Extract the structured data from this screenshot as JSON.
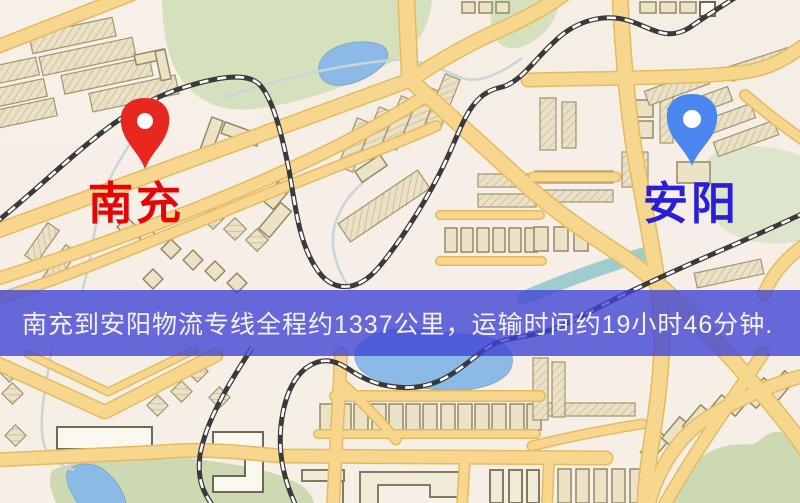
{
  "banner": {
    "text": "南充到安阳物流专线全程约1337公里，运输时间约19小时46分钟.",
    "background_color": "#3e42d6",
    "background_opacity": "0.78",
    "text_color": "#f3f3f8"
  },
  "route": {
    "origin": "南充",
    "destination": "安阳",
    "distance": "约1337公里",
    "duration": "约19小时46分钟"
  },
  "markers": {
    "origin": {
      "label": "南充",
      "label_color": "#e60505",
      "pin_color": "#e8281e"
    },
    "destination": {
      "label": "安阳",
      "label_color": "#2a1fd6",
      "pin_color": "#4c86ef"
    }
  },
  "map": {
    "palette": {
      "background": "#f4eee4",
      "road_fill": "#f7d68d",
      "road_casing": "#e6ba60",
      "green_area": "#d5e0bd",
      "water": "#8cbae6",
      "river_teal": "#8fc5c9",
      "railway_dark": "#3a3a3a",
      "railway_dash": "#ffffff",
      "building_fill": "#eae1c6",
      "building_outline": "#a0966f"
    }
  }
}
